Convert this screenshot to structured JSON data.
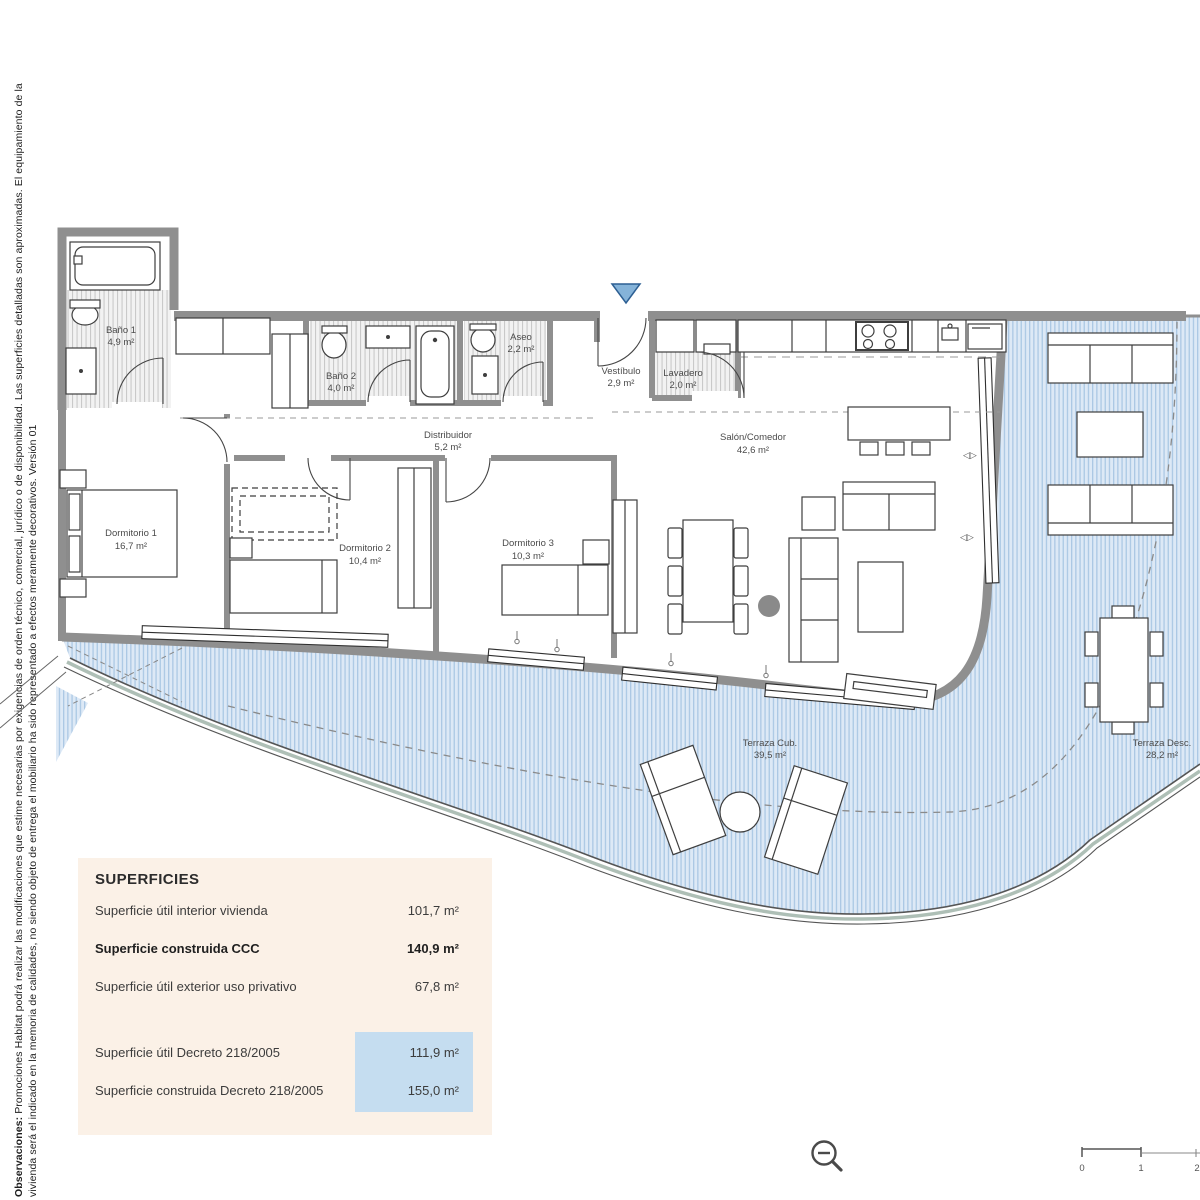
{
  "sidenote": {
    "prefix": "Observaciones:",
    "line1": " Promociones Habitat podrá realizar las modificaciones que estime necesarias por exigencias de orden técnico, comercial, jurídico o de disponibilidad. Las superficies detalladas son aproximadas. El equipamiento de la",
    "line2": "vivienda será el indicado en la memoria de calidades, no siendo objeto de entrega el mobiliario ha sido representado a efectos meramente decorativos. Versión 01"
  },
  "rooms": [
    {
      "name": "Baño 1",
      "area": "4,9 m²"
    },
    {
      "name": "Baño 2",
      "area": "4,0 m²"
    },
    {
      "name": "Aseo",
      "area": "2,2 m²"
    },
    {
      "name": "Vestíbulo",
      "area": "2,9 m²"
    },
    {
      "name": "Lavadero",
      "area": "2,0 m²"
    },
    {
      "name": "Distribuidor",
      "area": "5,2 m²"
    },
    {
      "name": "Salón/Comedor",
      "area": "42,6 m²"
    },
    {
      "name": "Dormitorio 1",
      "area": "16,7 m²"
    },
    {
      "name": "Dormitorio 2",
      "area": "10,4 m²"
    },
    {
      "name": "Dormitorio 3",
      "area": "10,3 m²"
    },
    {
      "name": "Terraza Cub.",
      "area": "39,5 m²"
    },
    {
      "name": "Terraza Desc.",
      "area": "28,2 m²"
    }
  ],
  "superficies": {
    "title": "SUPERFICIES",
    "rows": [
      {
        "label": "Superficie útil interior vivienda",
        "value": "101,7 m²"
      },
      {
        "label": "Superficie construida CCC",
        "value": "140,9 m²"
      },
      {
        "label": "Superficie útil exterior uso privativo",
        "value": "67,8 m²"
      },
      {
        "label": "Superficie útil Decreto 218/2005",
        "value": "111,9 m²"
      },
      {
        "label": "Superficie construida Decreto 218/2005",
        "value": "155,0 m²"
      }
    ]
  },
  "scalebar": {
    "ticks": [
      "0",
      "1",
      "2"
    ]
  },
  "colors": {
    "terrace_fill": "#dde9f6",
    "terrace_hatch": "#abc8e4",
    "wall": "#8f8f8f",
    "panel_bg": "#fbf1e7",
    "highlight": "#c5ddf0",
    "entrance": "#85b3d9"
  }
}
